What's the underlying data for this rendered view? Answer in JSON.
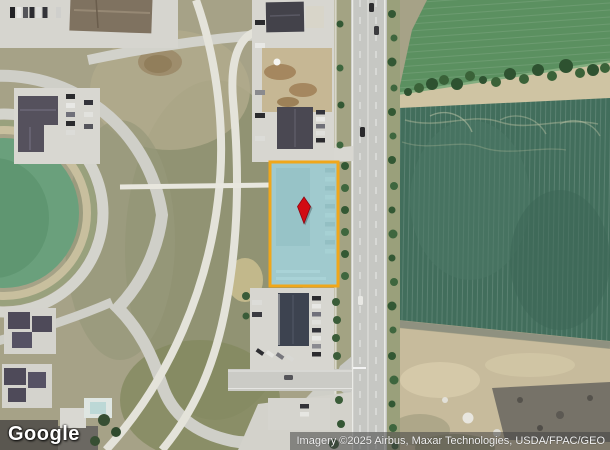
{
  "branding": {
    "logo_text": "Google"
  },
  "attribution": {
    "text": "Imagery ©2025 Airbus, Maxar Technologies, USDA/FPAC/GEO"
  },
  "parcel": {
    "fill_color": "#7ec8d2",
    "border_color": "#f0a71a",
    "marker_color": "#d20b12"
  }
}
